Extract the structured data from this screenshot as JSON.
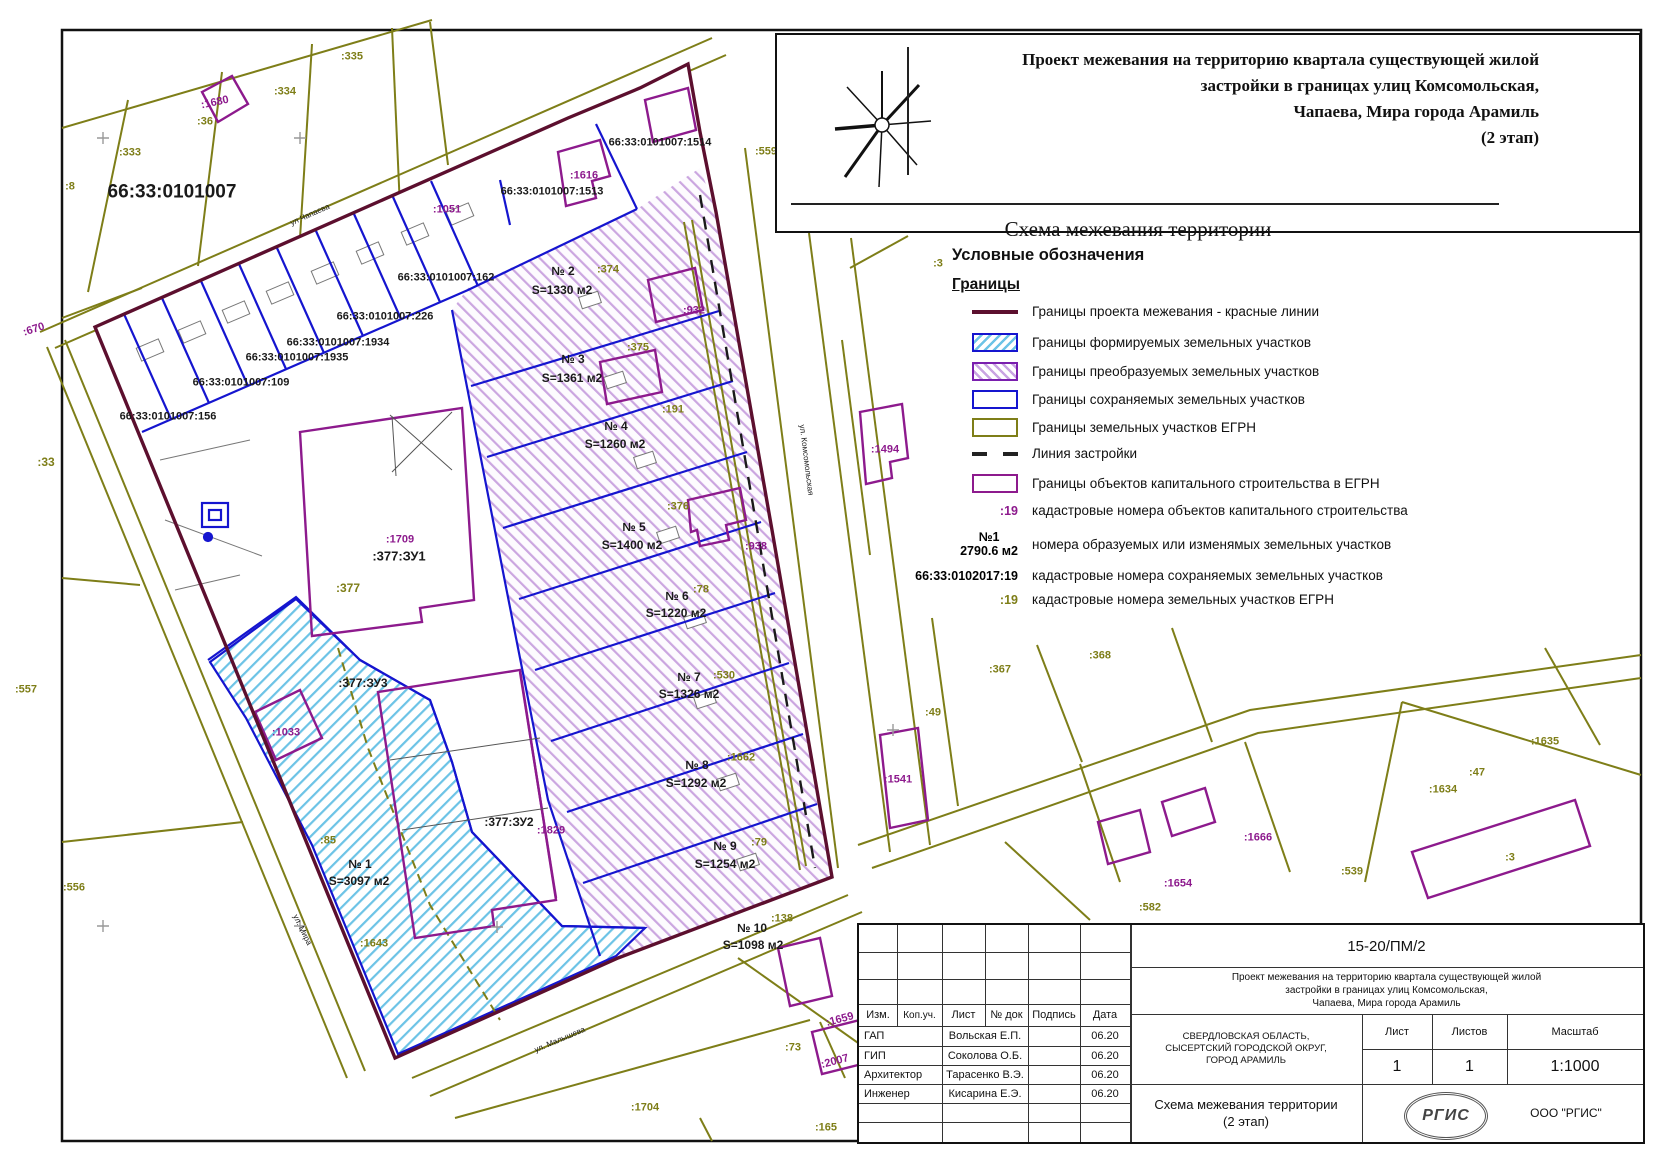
{
  "colors": {
    "olive": "#7e7e18",
    "purple": "#8d1a8d",
    "maroon": "#5c0f2e",
    "blue": "#1515cf",
    "black": "#1a1a1a"
  },
  "title_box": {
    "line1": "Проект межевания на территорию квартала существующей жилой",
    "line2": "застройки в границах улиц Комсомольская,",
    "line3": "Чапаева, Мира города Арамиль",
    "line4": "(2 этап)",
    "subtitle": "Схема межевания территории"
  },
  "legend": {
    "heading": "Условные обозначения",
    "subheading": "Границы",
    "items": [
      {
        "label": "Границы проекта межевания - красные линии"
      },
      {
        "label": "Границы формируемых земельных участков"
      },
      {
        "label": "Границы преобразуемых земельных участков"
      },
      {
        "label": "Границы сохраняемых земельных участков"
      },
      {
        "label": "Границы земельных участков ЕГРН"
      },
      {
        "label": "Линия застройки"
      },
      {
        "label": "Границы объектов капитального строительства в ЕГРН"
      },
      {
        "symbol": ":19",
        "label": "кадастровые номера объектов капитального строительства"
      },
      {
        "symbol": "№1",
        "symbol2": "2790.6 м2",
        "label": "номера образуемых или изменямых земельных участков"
      },
      {
        "symbol": "66:33:0102017:19",
        "label": "кадастровые номера сохраняемых земельных участков"
      },
      {
        "symbol": ":19",
        "label": "кадастровые номера земельных участков ЕГРН"
      }
    ]
  },
  "stamp": {
    "doc_number": "15-20/ПМ/2",
    "desc_line1": "Проект межевания на территорию квартала существующей жилой",
    "desc_line2": "застройки в границах улиц Комсомольская,",
    "desc_line3": "Чапаева, Мира города Арамиль",
    "cols": [
      "Изм.",
      "Коп.уч.",
      "Лист",
      "№ док",
      "Подпись",
      "Дата"
    ],
    "rows": [
      {
        "role": "ГАП",
        "name": "Вольская Е.П.",
        "date": "06.20"
      },
      {
        "role": "ГИП",
        "name": "Соколова О.Б.",
        "date": "06.20"
      },
      {
        "role": "Архитектор",
        "name": "Тарасенко В.Э.",
        "date": "06.20"
      },
      {
        "role": "Инженер",
        "name": "Кисарина Е.Э.",
        "date": "06.20"
      }
    ],
    "loc1": "СВЕРДЛОВСКАЯ ОБЛАСТЬ,",
    "loc2": "СЫСЕРТСКИЙ ГОРОДСКОЙ ОКРУГ,",
    "loc3": "ГОРОД АРАМИЛЬ",
    "sheet_label": "Лист",
    "sheets_label": "Листов",
    "scale_label": "Масштаб",
    "sheet_value": "1",
    "sheets_value": "1",
    "scale_value": "1:1000",
    "bottom_title1": "Схема межевания территории",
    "bottom_title2": "(2 этап)",
    "logo_text": "РГИС",
    "company": "ООО \"РГИС\""
  },
  "map": {
    "labels": [
      {
        "t": "66:33:0101007",
        "x": 172,
        "y": 192,
        "c": "k",
        "s": 19
      },
      {
        "t": "66:33:0101007:1514",
        "x": 660,
        "y": 143,
        "c": "k",
        "s": 11
      },
      {
        "t": "66:33:0101007:1513",
        "x": 552,
        "y": 192,
        "c": "k",
        "s": 11
      },
      {
        "t": "66:33:0101007:162",
        "x": 446,
        "y": 278,
        "c": "k",
        "s": 11
      },
      {
        "t": "66:33:0101007:226",
        "x": 385,
        "y": 317,
        "c": "k",
        "s": 11
      },
      {
        "t": "66:33:0101007:1934",
        "x": 338,
        "y": 343,
        "c": "k",
        "s": 11
      },
      {
        "t": "66:33:0101007:1935",
        "x": 297,
        "y": 358,
        "c": "k",
        "s": 11
      },
      {
        "t": "66:33:0101007:109",
        "x": 241,
        "y": 383,
        "c": "k",
        "s": 11
      },
      {
        "t": "66:33:0101007:156",
        "x": 168,
        "y": 417,
        "c": "k",
        "s": 11
      },
      {
        "t": ":335",
        "x": 352,
        "y": 57,
        "c": "o",
        "s": 11
      },
      {
        "t": ":334",
        "x": 285,
        "y": 92,
        "c": "o",
        "s": 11
      },
      {
        "t": ":36",
        "x": 205,
        "y": 122,
        "c": "o",
        "s": 11
      },
      {
        "t": ":333",
        "x": 130,
        "y": 153,
        "c": "o",
        "s": 11
      },
      {
        "t": ":8",
        "x": 70,
        "y": 187,
        "c": "o",
        "s": 11
      },
      {
        "t": ":33",
        "x": 46,
        "y": 462,
        "c": "o",
        "s": 12
      },
      {
        "t": ":557",
        "x": 26,
        "y": 690,
        "c": "o",
        "s": 11
      },
      {
        "t": ":556",
        "x": 74,
        "y": 888,
        "c": "o",
        "s": 11
      },
      {
        "t": ":374",
        "x": 608,
        "y": 270,
        "c": "o",
        "s": 11
      },
      {
        "t": ":375",
        "x": 638,
        "y": 348,
        "c": "o",
        "s": 11
      },
      {
        "t": ":191",
        "x": 673,
        "y": 410,
        "c": "o",
        "s": 11
      },
      {
        "t": ":376",
        "x": 678,
        "y": 507,
        "c": "o",
        "s": 11
      },
      {
        "t": ":78",
        "x": 701,
        "y": 590,
        "c": "o",
        "s": 11
      },
      {
        "t": ":530",
        "x": 724,
        "y": 676,
        "c": "o",
        "s": 11
      },
      {
        "t": ":1662",
        "x": 741,
        "y": 758,
        "c": "o",
        "s": 11
      },
      {
        "t": ":79",
        "x": 759,
        "y": 843,
        "c": "o",
        "s": 11
      },
      {
        "t": ":138",
        "x": 782,
        "y": 919,
        "c": "o",
        "s": 11
      },
      {
        "t": ":85",
        "x": 328,
        "y": 841,
        "c": "o",
        "s": 11
      },
      {
        "t": ":1643",
        "x": 374,
        "y": 944,
        "c": "o",
        "s": 11
      },
      {
        "t": ":377",
        "x": 348,
        "y": 588,
        "c": "o",
        "s": 12
      },
      {
        "t": ":559",
        "x": 766,
        "y": 152,
        "c": "o",
        "s": 11
      },
      {
        "t": ":3",
        "x": 938,
        "y": 264,
        "c": "o",
        "s": 11
      },
      {
        "t": ":367",
        "x": 1000,
        "y": 670,
        "c": "o",
        "s": 11
      },
      {
        "t": ":368",
        "x": 1100,
        "y": 656,
        "c": "o",
        "s": 11
      },
      {
        "t": ":49",
        "x": 933,
        "y": 713,
        "c": "o",
        "s": 11
      },
      {
        "t": ":1635",
        "x": 1545,
        "y": 742,
        "c": "o",
        "s": 11
      },
      {
        "t": ":47",
        "x": 1477,
        "y": 773,
        "c": "o",
        "s": 11
      },
      {
        "t": ":1634",
        "x": 1443,
        "y": 790,
        "c": "o",
        "s": 11
      },
      {
        "t": ":539",
        "x": 1352,
        "y": 872,
        "c": "o",
        "s": 11
      },
      {
        "t": ":3",
        "x": 1510,
        "y": 858,
        "c": "o",
        "s": 11
      },
      {
        "t": ":582",
        "x": 1150,
        "y": 908,
        "c": "o",
        "s": 11
      },
      {
        "t": ":165",
        "x": 826,
        "y": 1128,
        "c": "o",
        "s": 11
      },
      {
        "t": ":73",
        "x": 793,
        "y": 1048,
        "c": "o",
        "s": 11
      },
      {
        "t": ":1704",
        "x": 645,
        "y": 1108,
        "c": "o",
        "s": 11
      },
      {
        "t": ":1680",
        "x": 215,
        "y": 103,
        "c": "p",
        "s": 11,
        "r": -12
      },
      {
        "t": ":670",
        "x": 34,
        "y": 330,
        "c": "p",
        "s": 11,
        "r": -18
      },
      {
        "t": ":1051",
        "x": 447,
        "y": 210,
        "c": "p",
        "s": 11
      },
      {
        "t": ":1616",
        "x": 584,
        "y": 176,
        "c": "p",
        "s": 11
      },
      {
        "t": ":932",
        "x": 694,
        "y": 311,
        "c": "p",
        "s": 11
      },
      {
        "t": ":938",
        "x": 756,
        "y": 547,
        "c": "p",
        "s": 11
      },
      {
        "t": ":1709",
        "x": 400,
        "y": 540,
        "c": "p",
        "s": 11
      },
      {
        "t": ":1033",
        "x": 286,
        "y": 733,
        "c": "p",
        "s": 11
      },
      {
        "t": ":1829",
        "x": 551,
        "y": 831,
        "c": "p",
        "s": 11
      },
      {
        "t": ":1494",
        "x": 885,
        "y": 450,
        "c": "p",
        "s": 11
      },
      {
        "t": ":1541",
        "x": 898,
        "y": 780,
        "c": "p",
        "s": 11
      },
      {
        "t": ":1666",
        "x": 1258,
        "y": 838,
        "c": "p",
        "s": 11
      },
      {
        "t": ":1654",
        "x": 1178,
        "y": 884,
        "c": "p",
        "s": 11
      },
      {
        "t": ":1659",
        "x": 840,
        "y": 1020,
        "c": "p",
        "s": 11,
        "r": -15
      },
      {
        "t": ":2007",
        "x": 835,
        "y": 1062,
        "c": "p",
        "s": 11,
        "r": -15
      },
      {
        "t": ":377:ЗУ1",
        "x": 399,
        "y": 556,
        "c": "k",
        "s": 13
      },
      {
        "t": ":377:ЗУ3",
        "x": 363,
        "y": 683,
        "c": "k",
        "s": 12
      },
      {
        "t": ":377:ЗУ2",
        "x": 509,
        "y": 822,
        "c": "k",
        "s": 12
      },
      {
        "t": "№ 2",
        "x": 563,
        "y": 271,
        "c": "k",
        "s": 12
      },
      {
        "t": "S=1330 м2",
        "x": 562,
        "y": 290,
        "c": "k",
        "s": 12
      },
      {
        "t": "№ 3",
        "x": 573,
        "y": 359,
        "c": "k",
        "s": 12
      },
      {
        "t": "S=1361 м2",
        "x": 572,
        "y": 378,
        "c": "k",
        "s": 12
      },
      {
        "t": "№ 4",
        "x": 616,
        "y": 426,
        "c": "k",
        "s": 12
      },
      {
        "t": "S=1260 м2",
        "x": 615,
        "y": 444,
        "c": "k",
        "s": 12
      },
      {
        "t": "№ 5",
        "x": 634,
        "y": 527,
        "c": "k",
        "s": 12
      },
      {
        "t": "S=1400 м2",
        "x": 632,
        "y": 545,
        "c": "k",
        "s": 12
      },
      {
        "t": "№ 6",
        "x": 677,
        "y": 596,
        "c": "k",
        "s": 12
      },
      {
        "t": "S=1220 м2",
        "x": 676,
        "y": 613,
        "c": "k",
        "s": 12
      },
      {
        "t": "№ 7",
        "x": 689,
        "y": 677,
        "c": "k",
        "s": 12
      },
      {
        "t": "S=1326 м2",
        "x": 689,
        "y": 694,
        "c": "k",
        "s": 12
      },
      {
        "t": "№ 8",
        "x": 697,
        "y": 765,
        "c": "k",
        "s": 12
      },
      {
        "t": "S=1292 м2",
        "x": 696,
        "y": 783,
        "c": "k",
        "s": 12
      },
      {
        "t": "№ 9",
        "x": 725,
        "y": 846,
        "c": "k",
        "s": 12
      },
      {
        "t": "S=1254 м2",
        "x": 725,
        "y": 864,
        "c": "k",
        "s": 12
      },
      {
        "t": "№ 10",
        "x": 752,
        "y": 928,
        "c": "k",
        "s": 12
      },
      {
        "t": "S=1098 м2",
        "x": 753,
        "y": 945,
        "c": "k",
        "s": 12
      },
      {
        "t": "№ 1",
        "x": 360,
        "y": 864,
        "c": "k",
        "s": 12
      },
      {
        "t": "S=3097 м2",
        "x": 359,
        "y": 881,
        "c": "k",
        "s": 12
      },
      {
        "t": "ул Чапаева",
        "x": 310,
        "y": 215,
        "c": "k",
        "s": 8,
        "b": 0,
        "r": -24
      },
      {
        "t": "ул. Мира",
        "x": 302,
        "y": 930,
        "c": "k",
        "s": 8,
        "b": 0,
        "r": 64
      },
      {
        "t": "ул. Малышева",
        "x": 560,
        "y": 1040,
        "c": "k",
        "s": 8,
        "b": 0,
        "r": -23
      },
      {
        "t": "ул. Комсомольская",
        "x": 806,
        "y": 460,
        "c": "k",
        "s": 8,
        "b": 0,
        "r": 83
      }
    ]
  }
}
